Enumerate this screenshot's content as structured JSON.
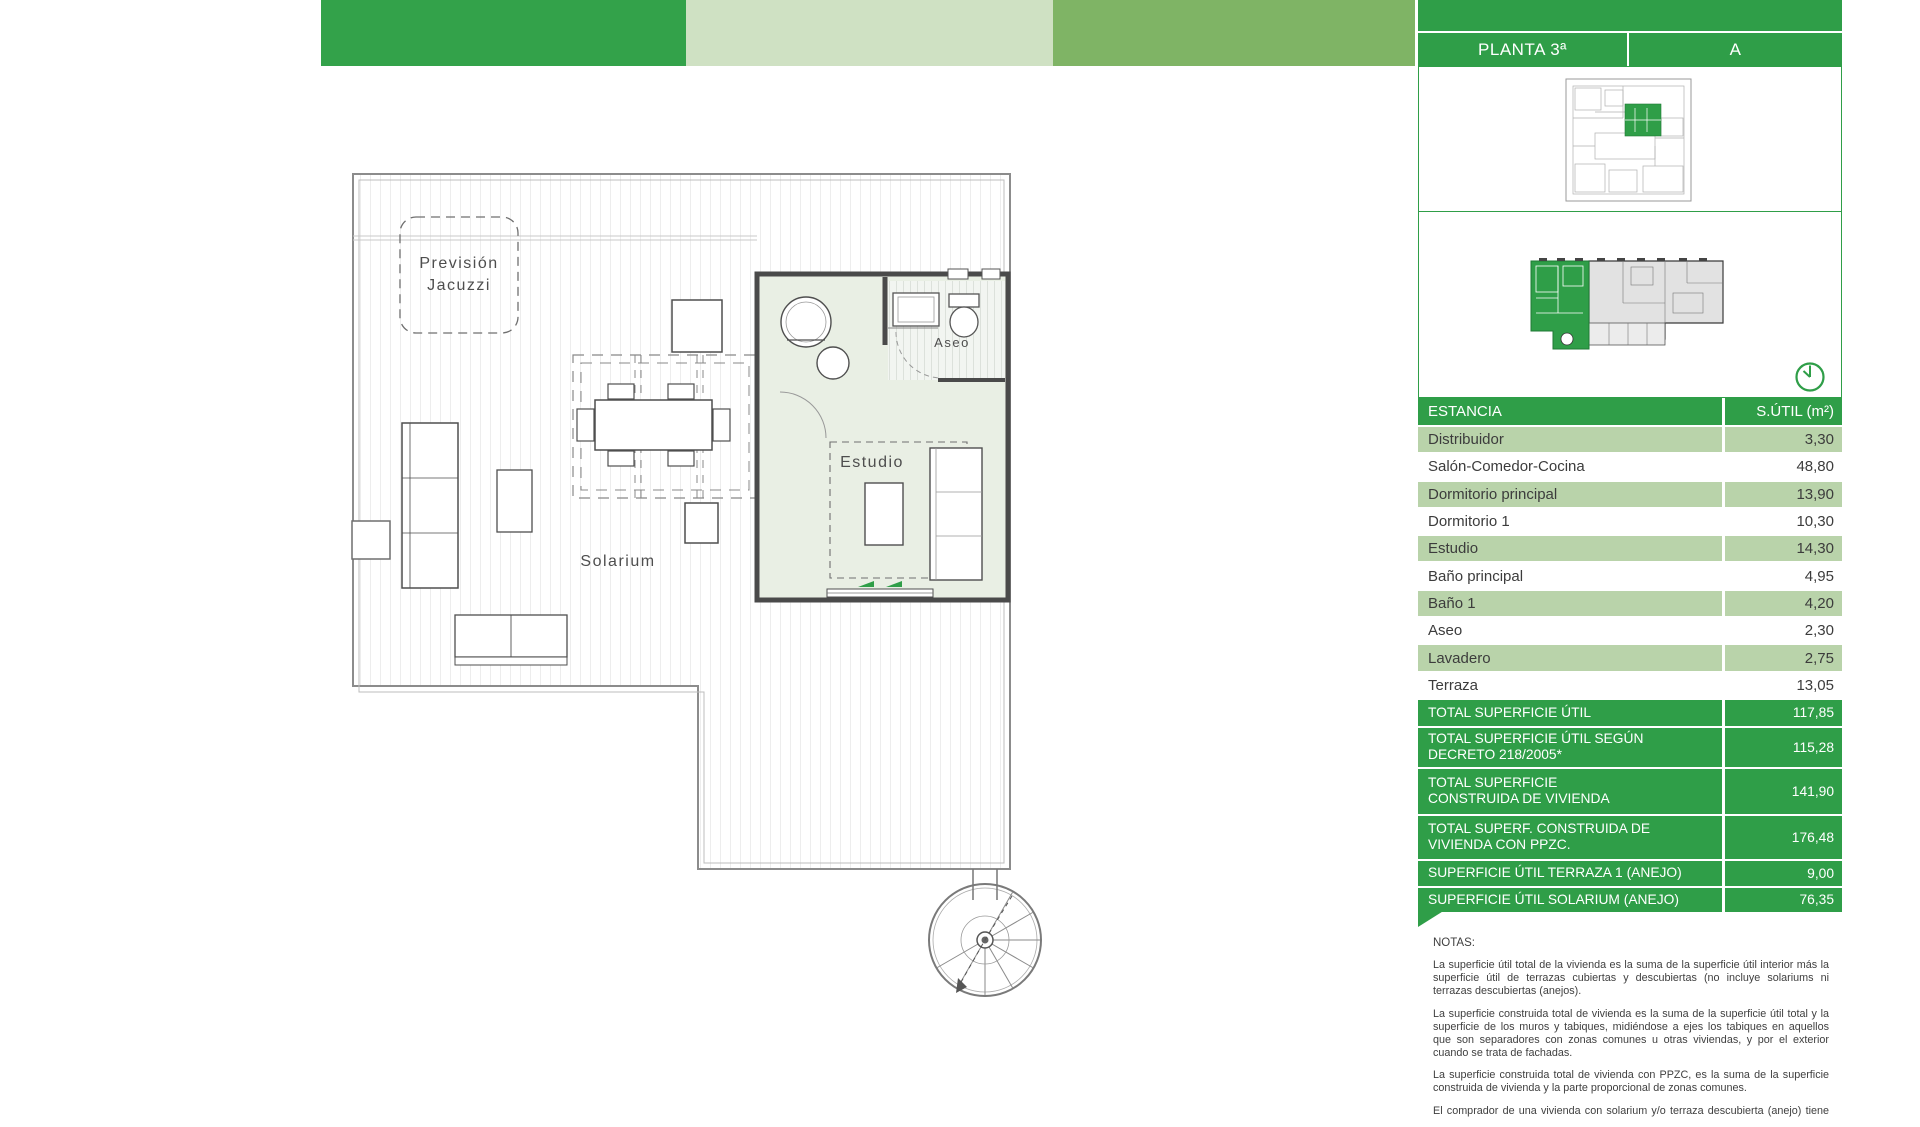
{
  "header": {
    "planta_label": "PLANTA 3ª",
    "unit_label": "A"
  },
  "plan_labels": {
    "prevision_line1": "Previsión",
    "prevision_line2": "Jacuzzi",
    "aseo": "Aseo",
    "estudio": "Estudio",
    "solarium": "Solarium"
  },
  "table": {
    "columns": [
      "ESTANCIA",
      "S.ÚTIL (m²)"
    ],
    "rows": [
      {
        "label": "Distribuidor",
        "value": "3,30"
      },
      {
        "label": "Salón-Comedor-Cocina",
        "value": "48,80"
      },
      {
        "label": "Dormitorio principal",
        "value": "13,90"
      },
      {
        "label": "Dormitorio 1",
        "value": "10,30"
      },
      {
        "label": "Estudio",
        "value": "14,30"
      },
      {
        "label": "Baño principal",
        "value": "4,95"
      },
      {
        "label": "Baño 1",
        "value": "4,20"
      },
      {
        "label": "Aseo",
        "value": "2,30"
      },
      {
        "label": "Lavadero",
        "value": "2,75"
      },
      {
        "label": "Terraza",
        "value": "13,05"
      }
    ],
    "totals": [
      {
        "label": "TOTAL SUPERFICIE ÚTIL",
        "value": "117,85"
      },
      {
        "label": "TOTAL SUPERFICIE ÚTIL SEGÚN\nDECRETO 218/2005*",
        "value": "115,28"
      },
      {
        "label": "TOTAL SUPERFICIE\nCONSTRUIDA DE VIVIENDA",
        "value": "141,90"
      },
      {
        "label": "TOTAL SUPERF. CONSTRUIDA DE\nVIVIENDA CON PPZC.",
        "value": "176,48"
      },
      {
        "label": "SUPERFICIE ÚTIL TERRAZA 1 (ANEJO)",
        "value": "9,00"
      },
      {
        "label": "SUPERFICIE ÚTIL SOLARIUM (ANEJO)",
        "value": "76,35"
      }
    ]
  },
  "notes": {
    "title": "NOTAS:",
    "paragraphs": [
      "La superficie útil total de la vivienda es la suma de la superficie útil interior más la superficie útil de terrazas cubiertas y descubiertas (no incluye solariums ni terrazas descubiertas (anejos).",
      "La superficie construida total de vivienda es la suma de la superficie útil total y la superficie de los muros y tabiques, midiéndose a ejes los tabiques en aquellos que son separadores con zonas comunes u otras viviendas, y por el exterior cuando se trata de fachadas.",
      "La superficie construida total de vivienda con PPZC, es la suma de la superficie construida de vivienda y la parte proporcional de zonas comunes.",
      "El comprador de una vivienda con solarium y/o terraza descubierta (anejo) tiene"
    ]
  },
  "colors": {
    "accent_green": "#2f9e48",
    "bar_dark_green": "#33a24a",
    "bar_pale_green": "#cfe1c3",
    "bar_mid_green": "#7fb465",
    "row_light_green": "#b9d3aa",
    "room_fill": "#e9efe4"
  }
}
